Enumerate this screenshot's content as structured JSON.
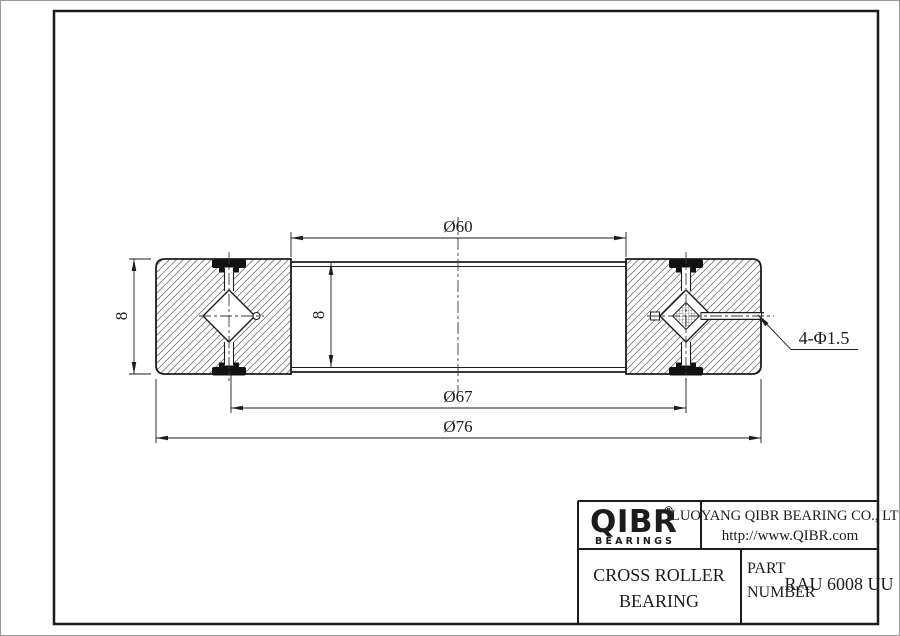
{
  "title_block": {
    "logo": {
      "text": "QIBR",
      "registered": "®",
      "subtext": "BEARINGS"
    },
    "company": {
      "line1": "LUOYANG QIBR BEARING CO., LTD",
      "line2": "http://www.QIBR.com"
    },
    "product": {
      "line1": "CROSS ROLLER",
      "line2": "BEARING"
    },
    "part": {
      "label_line1": "PART",
      "label_line2": "NUMBER",
      "value": "RAU 6008 UU"
    }
  },
  "dimensions": {
    "bore_diameter": "Ø60",
    "pitch_diameter": "Ø67",
    "outer_diameter": "Ø76",
    "section_height": "8",
    "inner_ring_width": "8",
    "hole_callout": "4-Φ1.5"
  },
  "colors": {
    "line": "#1c1c1c",
    "hatch": "#7d7d7d",
    "seal_fill": "#111111",
    "background": "#ffffff"
  }
}
